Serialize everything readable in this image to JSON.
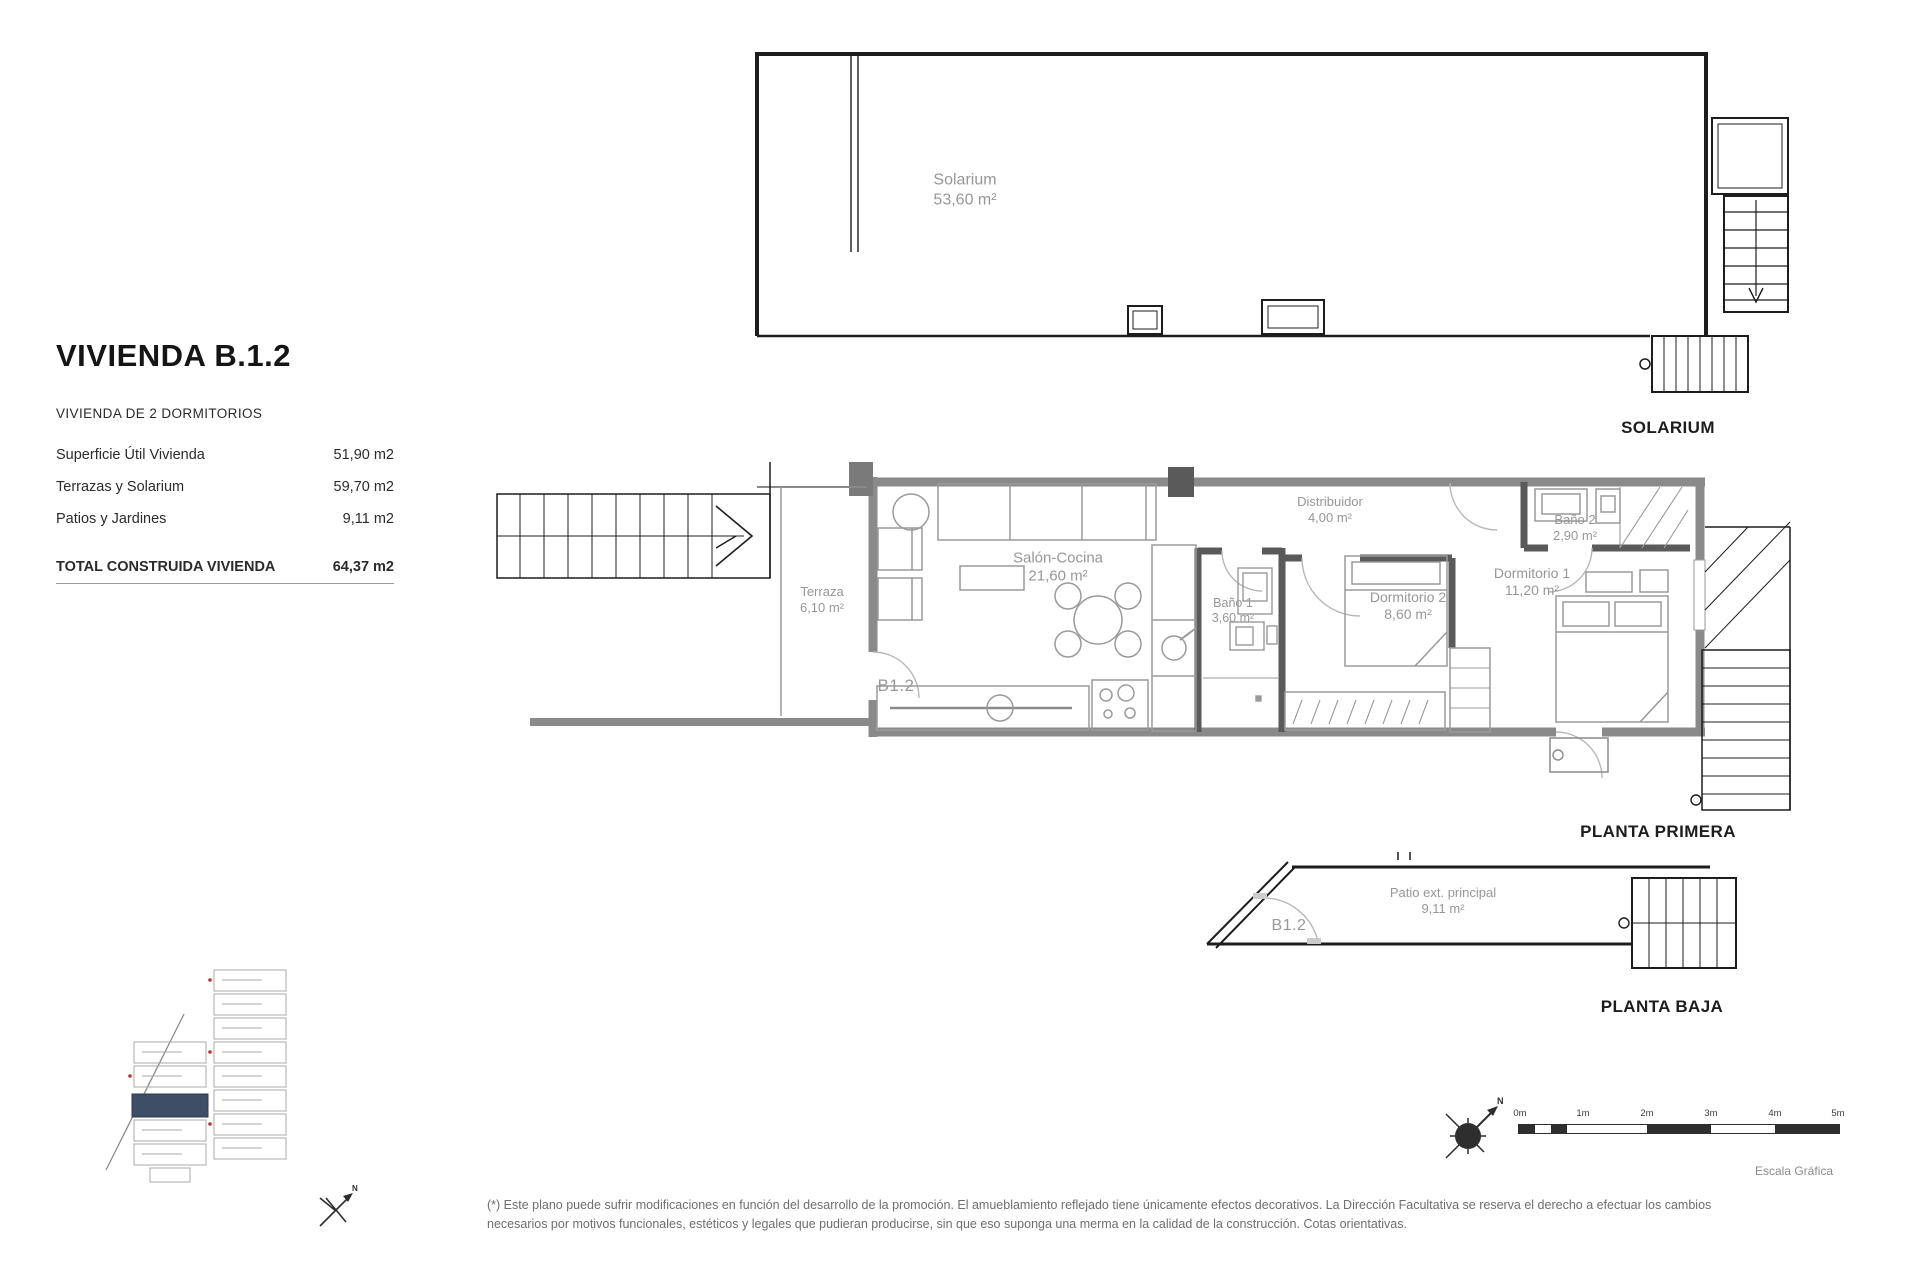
{
  "header": {
    "title": "VIVIENDA B.1.2",
    "subtitle": "VIVIENDA DE 2 DORMITORIOS"
  },
  "areas_table": {
    "rows": [
      {
        "label": "Superficie Útil Vivienda",
        "value": "51,90 m2"
      },
      {
        "label": "Terrazas y Solarium",
        "value": "59,70 m2"
      },
      {
        "label": "Patios y Jardines",
        "value": "9,11 m2"
      }
    ],
    "total_label": "TOTAL CONSTRUIDA VIVIENDA",
    "total_value": "64,37 m2"
  },
  "solarium_plan": {
    "caption": "SOLARIUM",
    "room_name": "Solarium",
    "room_area": "53,60 m²"
  },
  "first_floor_plan": {
    "caption": "PLANTA PRIMERA",
    "unit_code": "B1.2",
    "rooms": [
      {
        "name": "Terraza",
        "area": "6,10 m²"
      },
      {
        "name": "Salón-Cocina",
        "area": "21,60 m²"
      },
      {
        "name": "Baño 1",
        "area": "3,60 m²"
      },
      {
        "name": "Distribuidor",
        "area": "4,00 m²"
      },
      {
        "name": "Dormitorio 2",
        "area": "8,60 m²"
      },
      {
        "name": "Dormitorio 1",
        "area": "11,20 m²"
      },
      {
        "name": "Baño 2",
        "area": "2,90 m²"
      }
    ]
  },
  "ground_floor_plan": {
    "caption": "PLANTA BAJA",
    "unit_code": "B1.2",
    "room_name": "Patio ext. principal",
    "room_area": "9,11 m²"
  },
  "scale_bar": {
    "ticks": [
      "0m",
      "1m",
      "2m",
      "3m",
      "4m",
      "5m"
    ],
    "caption": "Escala Gráfica"
  },
  "compass": {
    "north_label": "N"
  },
  "footnote": "(*) Este plano puede sufrir modificaciones en función del desarrollo de la promoción. El amueblamiento reflejado tiene únicamente efectos decorativos. La Dirección Facultativa se reserva el derecho a efectuar los cambios necesarios por motivos funcionales, estéticos y legales que pudieran producirse, sin que eso suponga una merma en la calidad de la construcción. Cotas orientativas.",
  "colors": {
    "wall_black": "#1d1d1d",
    "wall_gray": "#8a8a8a",
    "partition_gray": "#5a5a5a",
    "label_gray": "#979797",
    "highlight_unit": "#3d4e66"
  }
}
